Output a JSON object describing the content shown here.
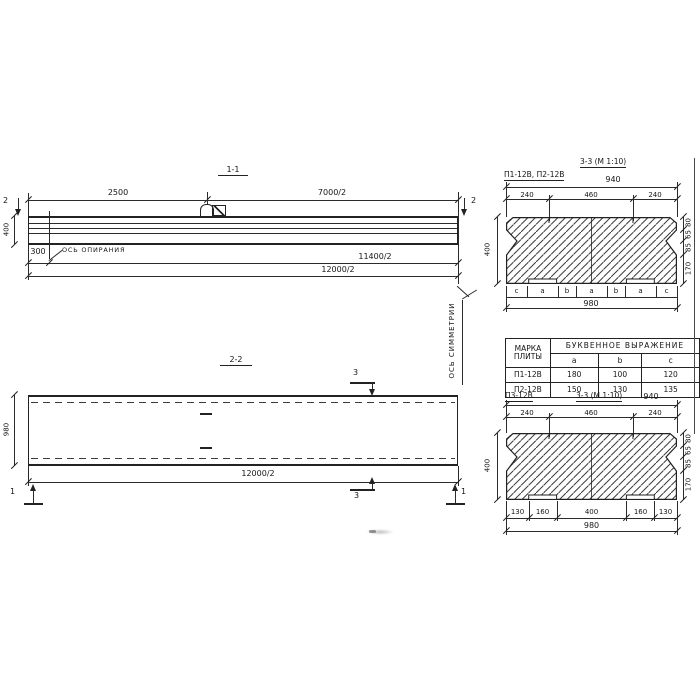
{
  "s11": {
    "title": "1-1",
    "dim2500": "2500",
    "dim7000": "7000/2",
    "dim400": "400",
    "dim300": "300",
    "dim11400": "11400/2",
    "dim12000": "12000/2",
    "support_axis": "ОСЬ ОПИРАНИЯ",
    "marker": "2"
  },
  "s22": {
    "title": "2-2",
    "dim980": "980",
    "dim12000": "12000/2",
    "symmetry_axis": "ОСЬ СИММЕТРИИ",
    "marker3": "3",
    "marker1": "1"
  },
  "t33a": {
    "plates": "П1-12В, П2-12В",
    "title": "3-3 (М 1:10)",
    "dim940": "940",
    "seg": [
      "240",
      "460",
      "240"
    ],
    "dim400": "400",
    "chain": [
      "80",
      "65",
      "85",
      "170"
    ],
    "letters": [
      "c",
      "a",
      "b",
      "a",
      "b",
      "a",
      "c"
    ],
    "dim980": "980"
  },
  "t33b": {
    "plate": "П3-12В",
    "title": "3-3 (М 1:10)",
    "dim940": "940",
    "seg": [
      "240",
      "460",
      "240"
    ],
    "dim400": "400",
    "chain": [
      "80",
      "65",
      "85",
      "170"
    ],
    "bottom": [
      "130",
      "160",
      "400",
      "160",
      "130"
    ],
    "dim980": "980"
  },
  "table": {
    "c1": "МАРКА",
    "c1b": "ПЛИТЫ",
    "span": "БУКВЕННОЕ  ВЫРАЖЕНИЕ",
    "cols": [
      "a",
      "b",
      "c"
    ],
    "rows": [
      {
        "m": "П1-12В",
        "a": "180",
        "b": "100",
        "c": "120"
      },
      {
        "m": "П2-12В",
        "a": "150",
        "b": "130",
        "c": "135"
      }
    ]
  }
}
